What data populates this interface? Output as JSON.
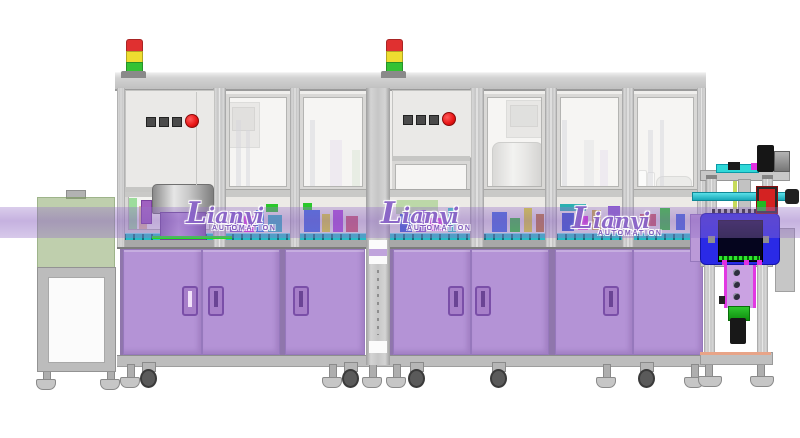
{
  "watermark": {
    "brand": "Lianyi",
    "subtitle": "AUTOMATION",
    "color": "#8a64c8",
    "instances": 3
  },
  "palette": {
    "background": "#ffffff",
    "frame_gray": "#c9c9c7",
    "panel_gray": "#eae9e7",
    "glass": "rgba(252,252,250,0.55)",
    "cabinet_purple": "#b493d6",
    "highlight_band_purple": "rgba(146,108,196,0.42)",
    "infeed_hood_green": "rgba(139,168,106,0.55)",
    "conveyor_teal": "#26bcc6",
    "station_blue": "#2a2ae6",
    "accent_magenta": "#e030e0",
    "accent_green": "#2ac82a",
    "signal_red": "#e03030",
    "signal_yellow": "#eedd30",
    "signal_green": "#34c234",
    "stop_button_red": "#e81414",
    "square_button_gray": "#4b4b4b"
  },
  "signal_tower": {
    "count": 2,
    "segment_colors": [
      "#e03030",
      "#eedd30",
      "#34c234"
    ]
  },
  "control_panel": {
    "square_buttons": 3,
    "emergency_buttons": 1
  },
  "machinery_blocks": {
    "module1": [
      {
        "x": 128,
        "y": 198,
        "w": 9,
        "h": 34,
        "c": "#2bb82b"
      },
      {
        "x": 139,
        "y": 206,
        "w": 8,
        "h": 26,
        "c": "#c07830"
      },
      {
        "x": 230,
        "y": 212,
        "w": 12,
        "h": 20,
        "c": "#8a5ad0"
      },
      {
        "x": 244,
        "y": 216,
        "w": 10,
        "h": 16,
        "c": "#e02ce0"
      },
      {
        "x": 256,
        "y": 210,
        "w": 8,
        "h": 22,
        "c": "#2a7ae8"
      },
      {
        "x": 266,
        "y": 204,
        "w": 12,
        "h": 8,
        "c": "#2ac82a"
      },
      {
        "x": 268,
        "y": 215,
        "w": 14,
        "h": 17,
        "c": "#30b8c0"
      },
      {
        "x": 304,
        "y": 210,
        "w": 16,
        "h": 22,
        "c": "#3a68e0"
      },
      {
        "x": 303,
        "y": 203,
        "w": 9,
        "h": 7,
        "c": "#2ac82a"
      },
      {
        "x": 322,
        "y": 214,
        "w": 8,
        "h": 18,
        "c": "#e0d82a"
      },
      {
        "x": 333,
        "y": 210,
        "w": 10,
        "h": 22,
        "c": "#aa48d8"
      },
      {
        "x": 346,
        "y": 216,
        "w": 12,
        "h": 16,
        "c": "#d05868"
      }
    ],
    "module2": [
      {
        "x": 396,
        "y": 200,
        "w": 42,
        "h": 14,
        "c": "#bcd8a8"
      },
      {
        "x": 400,
        "y": 214,
        "w": 12,
        "h": 18,
        "c": "#3058d8"
      },
      {
        "x": 416,
        "y": 210,
        "w": 10,
        "h": 22,
        "c": "#8a5ad0"
      },
      {
        "x": 430,
        "y": 218,
        "w": 13,
        "h": 13,
        "c": "#e02ce0"
      },
      {
        "x": 448,
        "y": 208,
        "w": 8,
        "h": 24,
        "c": "#2ac8c8"
      },
      {
        "x": 492,
        "y": 212,
        "w": 15,
        "h": 20,
        "c": "#3a68e0"
      },
      {
        "x": 510,
        "y": 218,
        "w": 10,
        "h": 14,
        "c": "#2ac82a"
      },
      {
        "x": 524,
        "y": 208,
        "w": 8,
        "h": 24,
        "c": "#e0d82a"
      },
      {
        "x": 536,
        "y": 214,
        "w": 8,
        "h": 18,
        "c": "#c07830"
      },
      {
        "x": 560,
        "y": 204,
        "w": 26,
        "h": 7,
        "c": "#2ab0b0"
      },
      {
        "x": 562,
        "y": 213,
        "w": 12,
        "h": 18,
        "c": "#2a50d0"
      },
      {
        "x": 578,
        "y": 216,
        "w": 10,
        "h": 14,
        "c": "#e02ce0"
      },
      {
        "x": 592,
        "y": 210,
        "w": 9,
        "h": 20,
        "c": "#c8a838"
      },
      {
        "x": 608,
        "y": 206,
        "w": 12,
        "h": 24,
        "c": "#8a5ad0"
      },
      {
        "x": 640,
        "y": 214,
        "w": 16,
        "h": 12,
        "c": "#d05858"
      },
      {
        "x": 660,
        "y": 208,
        "w": 10,
        "h": 22,
        "c": "#2ac82a"
      },
      {
        "x": 676,
        "y": 214,
        "w": 9,
        "h": 16,
        "c": "#3a68e0"
      }
    ],
    "ghosts": [
      {
        "x": 236,
        "y": 120,
        "w": 5,
        "h": 66,
        "c": "rgba(170,170,185,0.5)"
      },
      {
        "x": 246,
        "y": 130,
        "w": 4,
        "h": 56,
        "c": "rgba(170,170,185,0.5)"
      },
      {
        "x": 310,
        "y": 120,
        "w": 5,
        "h": 66,
        "c": "rgba(170,170,185,0.5)"
      },
      {
        "x": 330,
        "y": 140,
        "w": 12,
        "h": 46,
        "c": "rgba(200,180,220,0.45)"
      },
      {
        "x": 352,
        "y": 150,
        "w": 8,
        "h": 36,
        "c": "rgba(180,200,170,0.5)"
      },
      {
        "x": 562,
        "y": 120,
        "w": 5,
        "h": 66,
        "c": "rgba(170,170,185,0.5)"
      },
      {
        "x": 584,
        "y": 140,
        "w": 10,
        "h": 46,
        "c": "rgba(190,190,200,0.45)"
      },
      {
        "x": 600,
        "y": 150,
        "w": 8,
        "h": 36,
        "c": "rgba(200,180,220,0.45)"
      },
      {
        "x": 648,
        "y": 130,
        "w": 5,
        "h": 56,
        "c": "rgba(170,170,185,0.5)"
      },
      {
        "x": 660,
        "y": 120,
        "w": 4,
        "h": 66,
        "c": "rgba(170,170,185,0.5)"
      }
    ]
  }
}
